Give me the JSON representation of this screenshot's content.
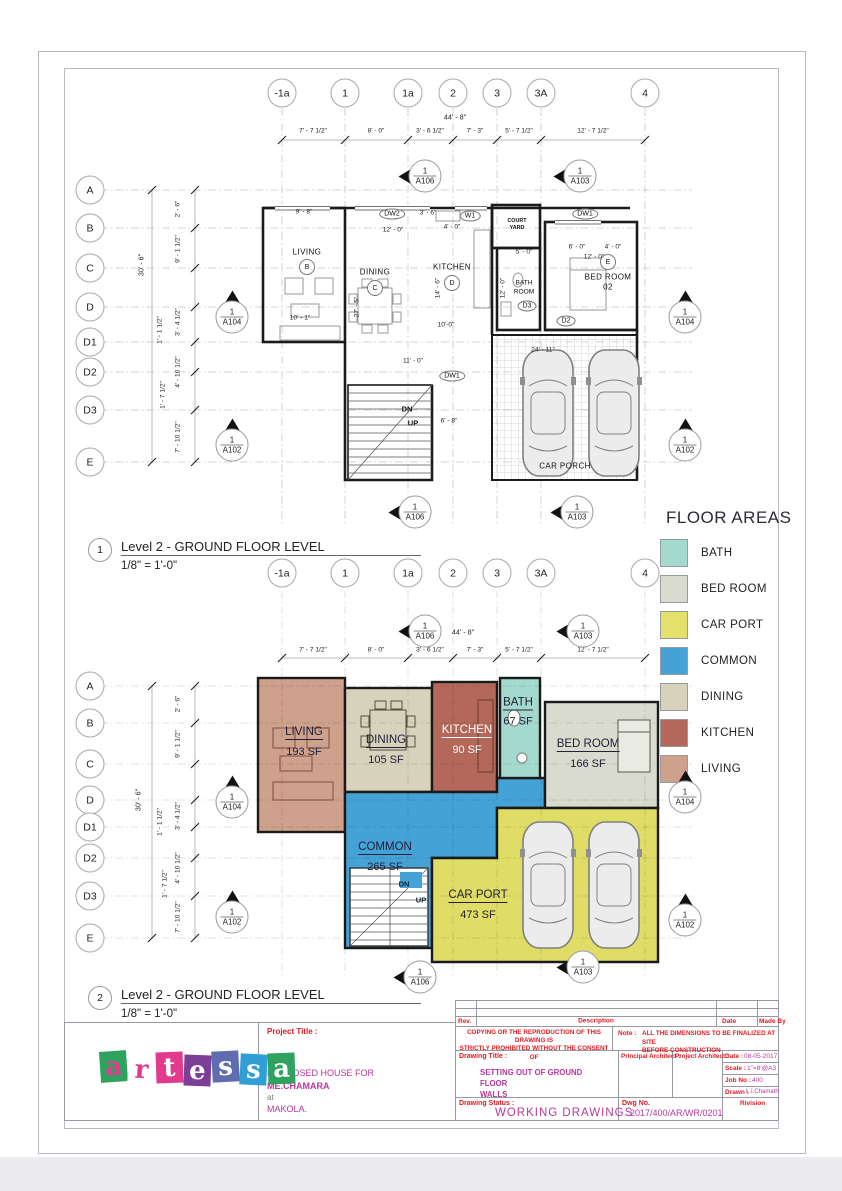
{
  "plans": {
    "p1": {
      "no": "1",
      "name": "Level 2 - GROUND FLOOR LEVEL",
      "scale": "1/8\" = 1'-0\""
    },
    "p2": {
      "no": "2",
      "name": "Level 2 - GROUND FLOOR LEVEL",
      "scale": "1/8\" = 1'-0\""
    }
  },
  "grid": {
    "cols": [
      "-1a",
      "1",
      "1a",
      "2",
      "3",
      "3A",
      "4"
    ],
    "rows": [
      "A",
      "B",
      "C",
      "D",
      "D1",
      "D2",
      "D3",
      "E"
    ],
    "top_total": "44' - 8\"",
    "top_dims": [
      "7' - 7 1/2\"",
      "8' - 0\"",
      "3' - 6 1/2\"",
      "7' - 3\"",
      "5' - 7 1/2\"",
      "12' - 7 1/2\""
    ],
    "left_total": "30' - 6\"",
    "left_dims": [
      "2' - 6\"",
      "9' - 1 1/2\"",
      "3' - 4 1/2\"",
      "4' - 10 1/2\"",
      "7' - 10 1/2\""
    ],
    "left_offsets": [
      "1' - 1 1/2\"",
      "1' - 7 1/2\""
    ]
  },
  "markers": {
    "a102": {
      "no": "1",
      "sheet": "A102"
    },
    "a103": {
      "no": "1",
      "sheet": "A103"
    },
    "a104": {
      "no": "1",
      "sheet": "A104"
    },
    "a106": {
      "no": "1",
      "sheet": "A106"
    }
  },
  "plan1": {
    "rooms": {
      "living": {
        "label": "LIVING",
        "tag": "B"
      },
      "dining": {
        "label": "DINING",
        "tag": "C"
      },
      "kitchen": {
        "label": "KITCHEN",
        "tag": "D"
      },
      "bath": {
        "line1": "BATH",
        "line2": "ROOM"
      },
      "bedroom": {
        "line1": "BED ROOM",
        "line2": "02",
        "tag": "E"
      },
      "courtyard": {
        "line1": "COURT",
        "line2": "YARD"
      },
      "carporch": {
        "label": "CAR PORCH"
      }
    },
    "door_tags": {
      "dw2": "DW2",
      "w1": "W1",
      "dw1": "DW1",
      "d2": "D2",
      "d3": "D3"
    },
    "stairs": {
      "dn": "DN",
      "up": "UP"
    },
    "dims": [
      "9' - 8\"",
      "3' - 6\"",
      "12' - 0\"",
      "4' - 0\"",
      "5' - 0\"",
      "12' - 0\"",
      "14' - 6\"",
      "12' - 0\"",
      "11' - 0\"",
      "24' - 11\"",
      "6' - 8\"",
      "10' - 1\"",
      "27' - 5\"",
      "10'-0\"",
      "6' - 0\"",
      "4' - 0\""
    ]
  },
  "legend": {
    "title": "FLOOR AREAS",
    "items": [
      {
        "label": "BATH",
        "color": "#a3dacd"
      },
      {
        "label": "BED ROOM",
        "color": "#d8dbce"
      },
      {
        "label": "CAR PORT",
        "color": "#e3e06c"
      },
      {
        "label": "COMMON",
        "color": "#45a2d7"
      },
      {
        "label": "DINING",
        "color": "#d7d2bc"
      },
      {
        "label": "KITCHEN",
        "color": "#b4685a"
      },
      {
        "label": "LIVING",
        "color": "#cda18b"
      }
    ]
  },
  "plan2": {
    "rooms": {
      "living": {
        "label": "LIVING",
        "area": "193 SF",
        "color": "#cda18b"
      },
      "dining": {
        "label": "DINING",
        "area": "105 SF",
        "color": "#d7d2bc"
      },
      "kitchen": {
        "label": "KITCHEN",
        "area": "90 SF",
        "color": "#b4685a"
      },
      "bath": {
        "label": "BATH",
        "area": "67 SF",
        "color": "#a3dacd"
      },
      "bedroom": {
        "label": "BED ROOM",
        "area": "166 SF",
        "color": "#d8dbce"
      },
      "common": {
        "label": "COMMON",
        "area": "265 SF",
        "color": "#45a2d7"
      },
      "carport": {
        "label": "CAR PORT",
        "area": "473 SF",
        "color": "#e0dd66"
      }
    },
    "stairs": {
      "dn": "DN",
      "up": "UP"
    }
  },
  "titleblock": {
    "rev": "Rev.",
    "description": "Description",
    "date_h": "Date",
    "made_by": "Made By",
    "warning_l1": "COPYING OR THE REPRODUCTION OF THIS DRAWING IS",
    "warning_l2": "STRICTLY PROHIBITED WITHOUT THE CONSENT OF",
    "note_label": "Note :",
    "note_l1": "ALL THE DIMENSIONS TO BE FINALIZED AT SITE",
    "note_l2": "BEFORE CONSTRUCTION",
    "drawing_title_label": "Drawing Title :",
    "drawing_title_l1": "SETTING OUT OF GROUND FLOOR",
    "drawing_title_l2": "WALLS",
    "principal_architect": "Principal Architect :",
    "project_architect": "Project Architect :",
    "date_label": "Date :",
    "date": "08-05-2017",
    "scale_label": "Scale :",
    "scale": "1\"=8'@A3",
    "job_label": "Job No :",
    "job": "400",
    "drawn_label": "Drawn :",
    "drawn": "L.I.Chamath",
    "status_label": "Drawing Status :",
    "status": "WORKING DRAWINGS",
    "dwg_label": "Dwg No.",
    "dwg": "2017/400/AR/WR/0201",
    "revision": "Rivision",
    "project_title_label": "Project Title :",
    "project_line1": "PROPOSED HOUSE FOR",
    "project_line2": "ME.CHAMARA",
    "project_line3": "at",
    "project_line4": "MAKOLA."
  },
  "logo": {
    "letters": [
      {
        "ch": "a",
        "bg": "#2ea25e",
        "fg": "#e23a8e"
      },
      {
        "ch": "r",
        "bg": "#ffffff",
        "fg": "#e23a8e"
      },
      {
        "ch": "t",
        "bg": "#e23a8e",
        "fg": "#ffffff"
      },
      {
        "ch": "e",
        "bg": "#7b3f98",
        "fg": "#ffffff"
      },
      {
        "ch": "s",
        "bg": "#5f6cb0",
        "fg": "#ffffff"
      },
      {
        "ch": "s",
        "bg": "#2f9fd6",
        "fg": "#ffffff"
      },
      {
        "ch": "a",
        "bg": "#2ea25e",
        "fg": "#ffffff"
      }
    ]
  }
}
